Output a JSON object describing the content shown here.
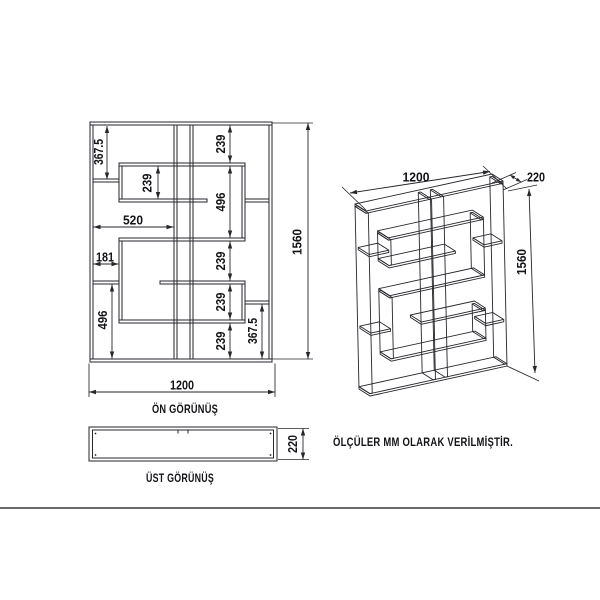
{
  "note": "ÖLÇÜLER MM OLARAK VERİLMİŞTİR.",
  "front_view": {
    "label": "ÖN GÖRÜNÜŞ",
    "dims": {
      "top_left_height": "367.5",
      "upper_box_inner_height": "239",
      "upper_opening_width": "520",
      "left_gap_width": "181",
      "lower_left_height": "496",
      "col_top_height": "239",
      "col_box_height": "496",
      "col_mid_upper_height": "239",
      "col_mid_lower_height": "239",
      "col_bottom_height": "239",
      "bottom_right_height": "367.5",
      "total_width": "1200",
      "total_height": "1560"
    }
  },
  "top_view": {
    "label": "ÜST GÖRÜNÜŞ",
    "depth": "220"
  },
  "iso_view": {
    "width": "1200",
    "depth": "220",
    "height": "1560"
  },
  "colors": {
    "line": "#26262c",
    "text": "#141418",
    "background": "#ffffff"
  }
}
